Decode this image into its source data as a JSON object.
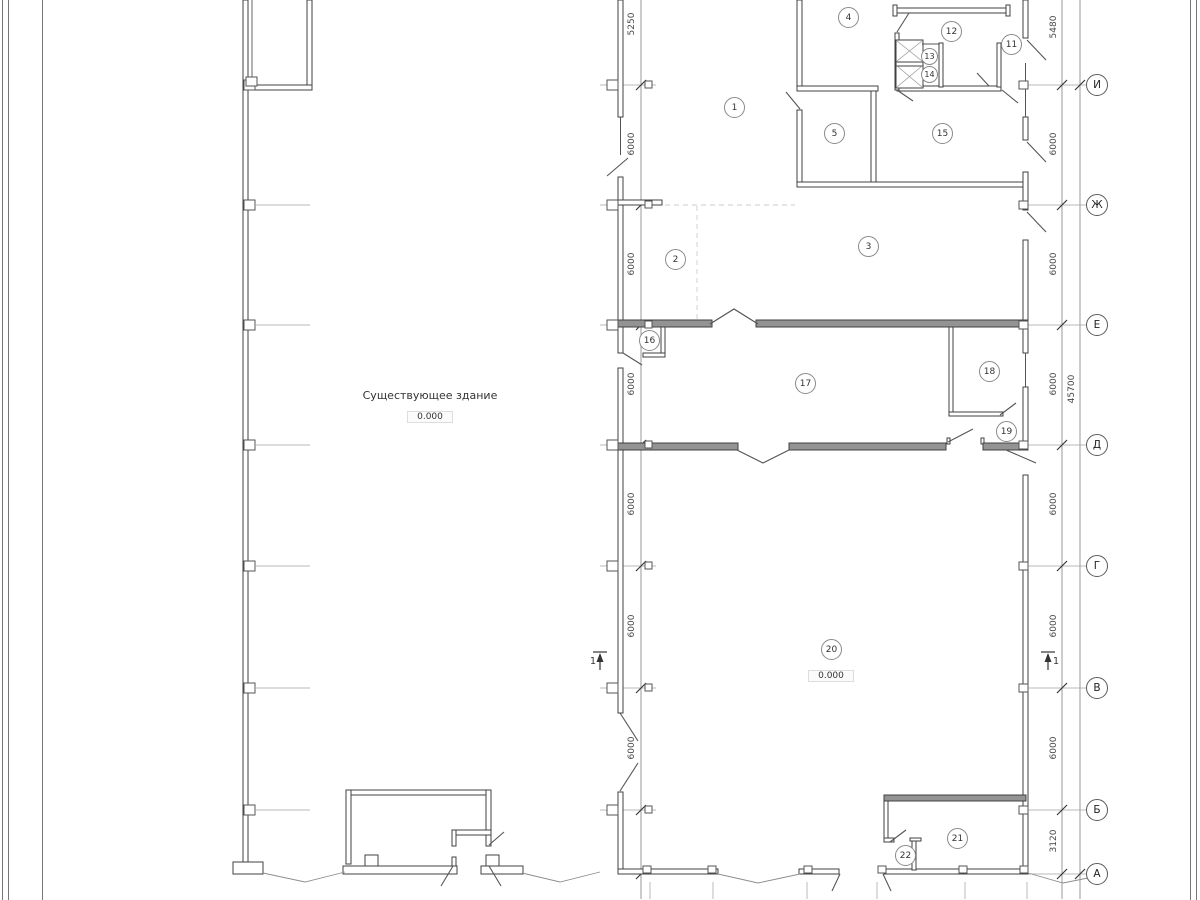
{
  "plan": {
    "building_label": "Существующее здание",
    "elevation_existing": "0.000",
    "elevation_new": "0.000",
    "section_label": "1",
    "rooms": [
      "1",
      "2",
      "3",
      "4",
      "5",
      "11",
      "12",
      "13",
      "14",
      "15",
      "16",
      "17",
      "18",
      "19",
      "20",
      "21",
      "22"
    ],
    "axes": [
      "И",
      "Ж",
      "Е",
      "Д",
      "Г",
      "В",
      "Б",
      "А"
    ],
    "left_dims": [
      "5250",
      "6000",
      "6000",
      "6000",
      "6000",
      "6000",
      "6000"
    ],
    "right_dims": [
      "5480",
      "6000",
      "6000",
      "6000",
      "6000",
      "6000",
      "6000",
      "3120"
    ],
    "total_dim": "45700",
    "colors": {
      "wall": "#414141",
      "gray_wall": "#939393",
      "thin_line": "#888888"
    }
  }
}
